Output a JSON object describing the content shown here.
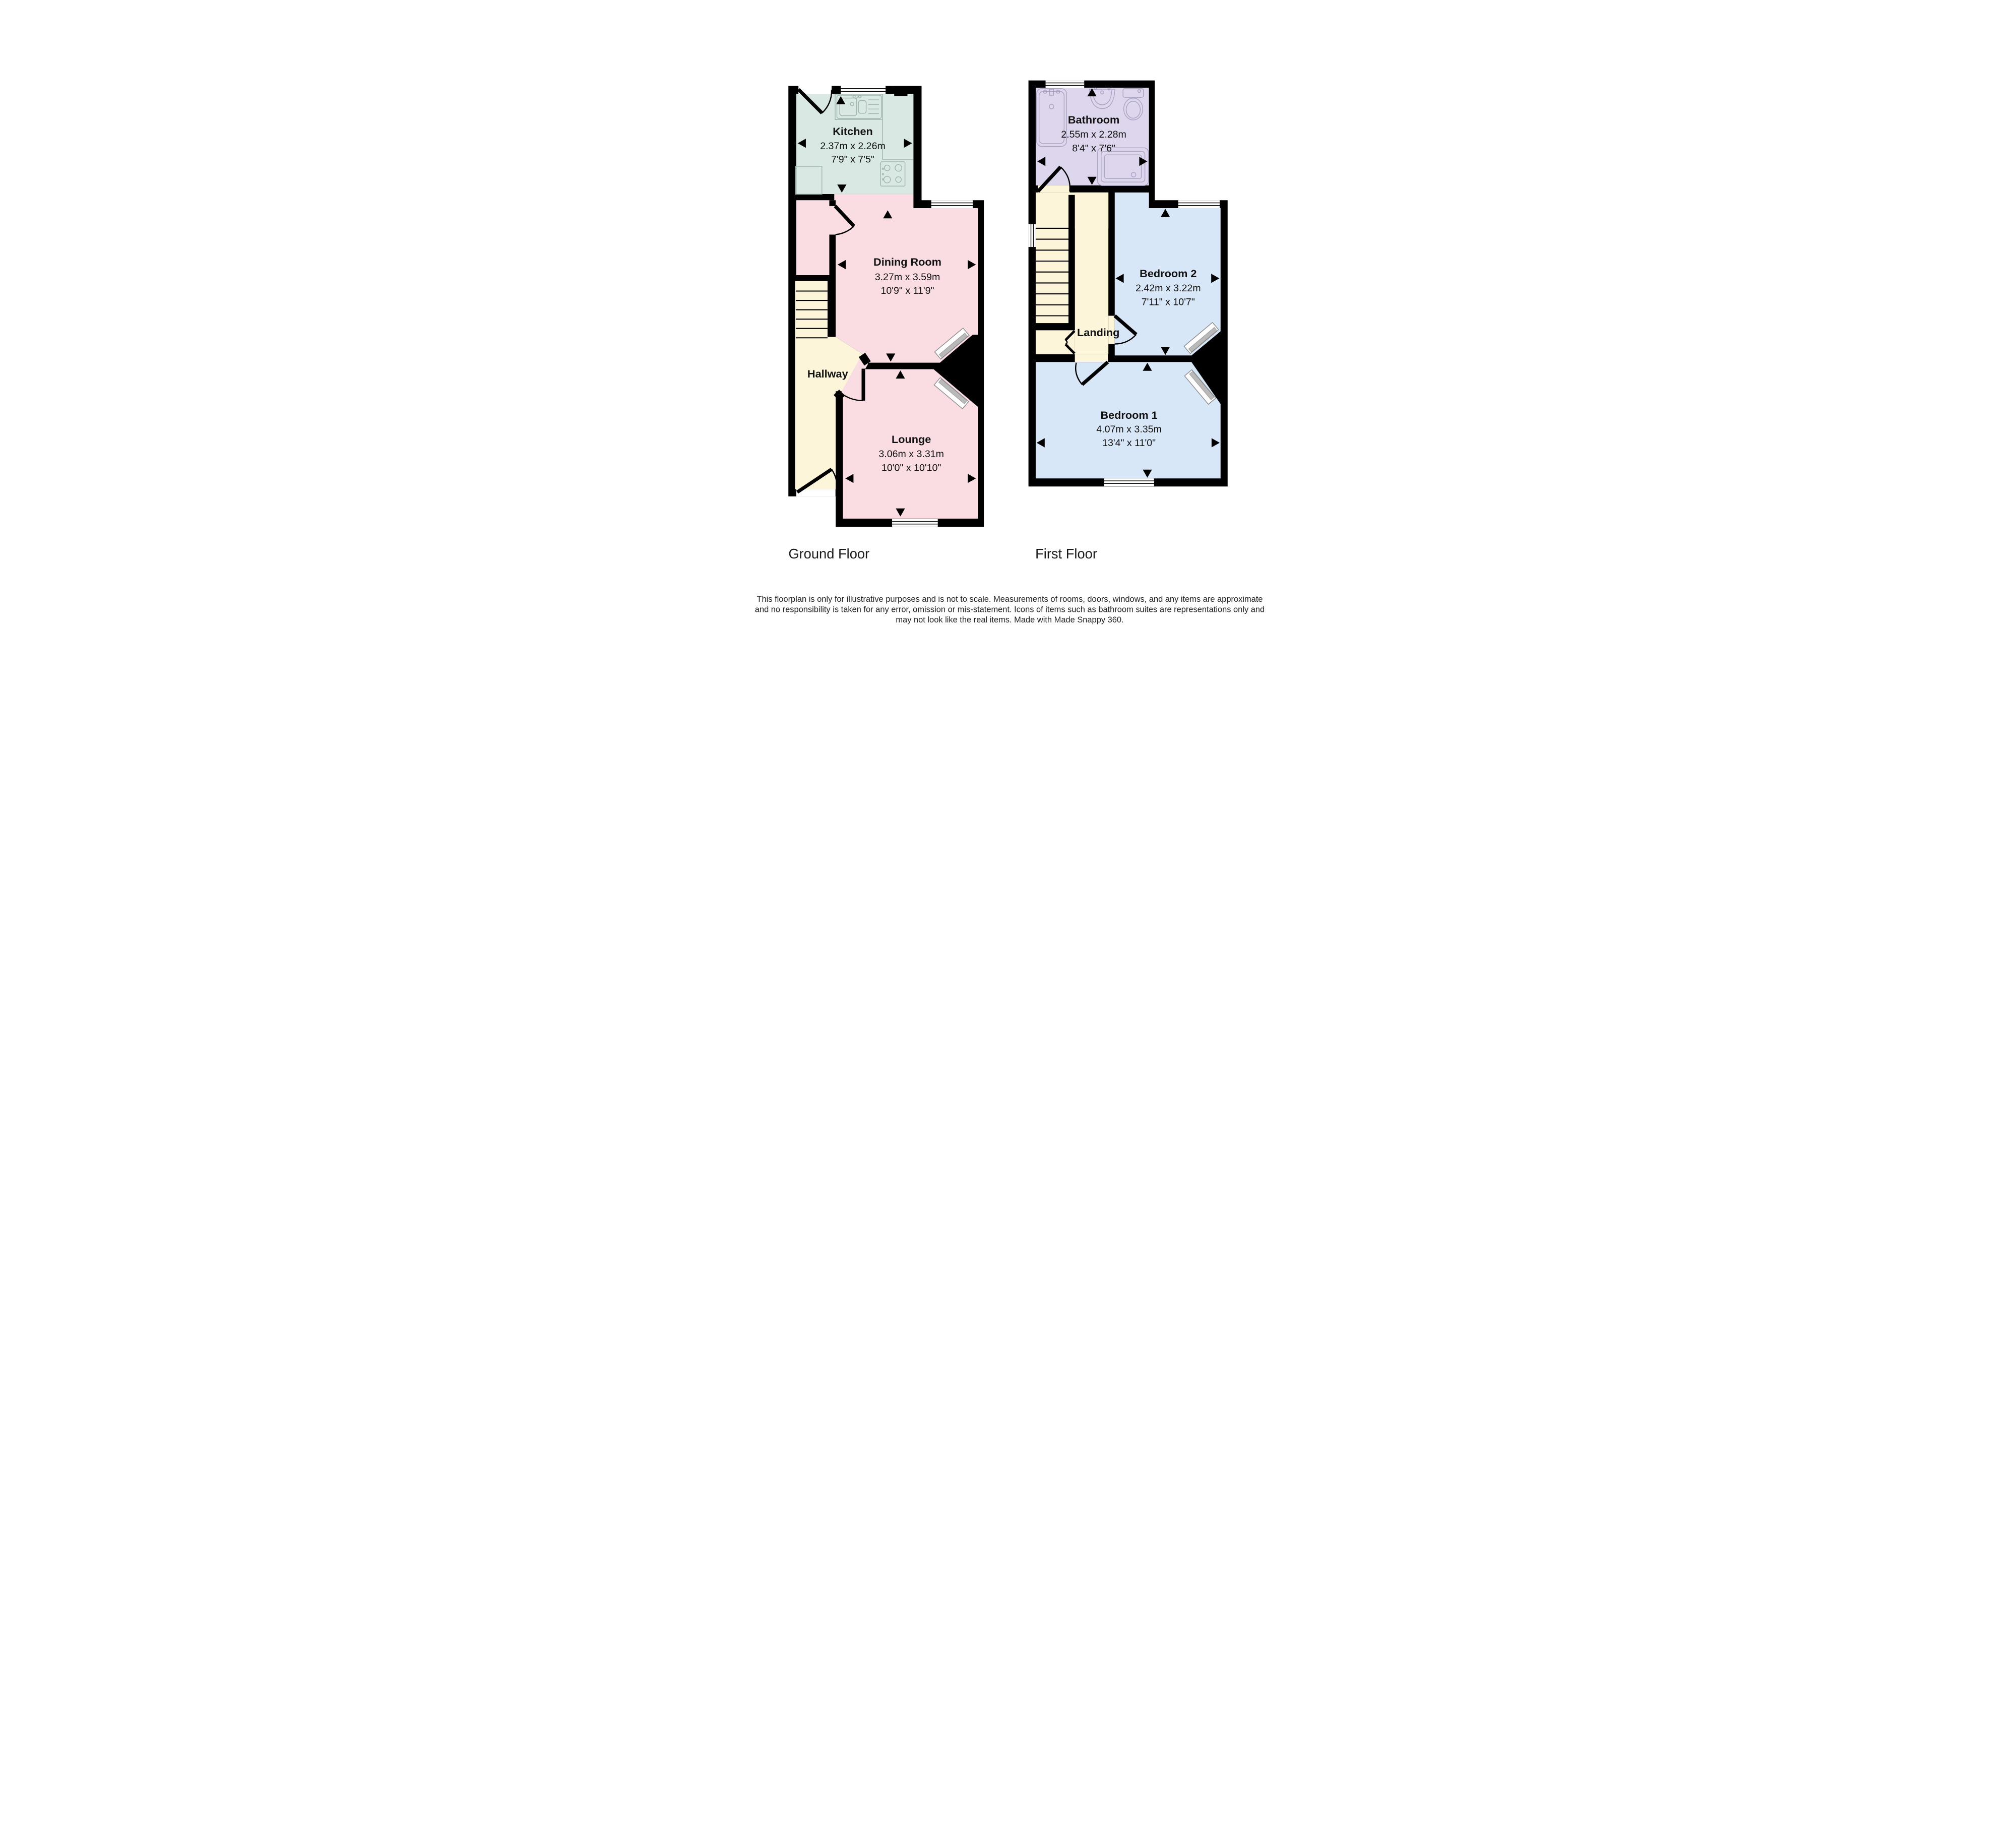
{
  "colors": {
    "kitchen": "#d9e8e2",
    "dining": "#fadde3",
    "lounge": "#fadde3",
    "hall": "#fcf5da",
    "bathroom": "#ddd6ec",
    "bedroom": "#d8e7f7",
    "wall": "#000000",
    "window": "#ffffff"
  },
  "ground_floor": {
    "label": "Ground Floor",
    "kitchen": {
      "name": "Kitchen",
      "metric": "2.37m x 2.26m",
      "imperial": "7'9\" x 7'5\""
    },
    "dining_room": {
      "name": "Dining Room",
      "metric": "3.27m x 3.59m",
      "imperial": "10'9\" x 11'9\""
    },
    "lounge": {
      "name": "Lounge",
      "metric": "3.06m x 3.31m",
      "imperial": "10'0\" x 10'10\""
    },
    "hallway": {
      "name": "Hallway"
    }
  },
  "first_floor": {
    "label": "First Floor",
    "bathroom": {
      "name": "Bathroom",
      "metric": "2.55m x 2.28m",
      "imperial": "8'4\" x 7'6\""
    },
    "bedroom_2": {
      "name": "Bedroom 2",
      "metric": "2.42m x 3.22m",
      "imperial": "7'11\" x 10'7\""
    },
    "bedroom_1": {
      "name": "Bedroom 1",
      "metric": "4.07m x 3.35m",
      "imperial": "13'4\" x 11'0\""
    },
    "landing": {
      "name": "Landing"
    }
  },
  "disclaimer": {
    "line1": "This floorplan is only for illustrative purposes and is not to scale. Measurements of rooms, doors, windows, and any items are approximate",
    "line2": "and no responsibility is taken for any error, omission or mis-statement. Icons of items such as bathroom suites are representations only and",
    "line3": "may not look like the real items. Made with Made Snappy 360."
  }
}
